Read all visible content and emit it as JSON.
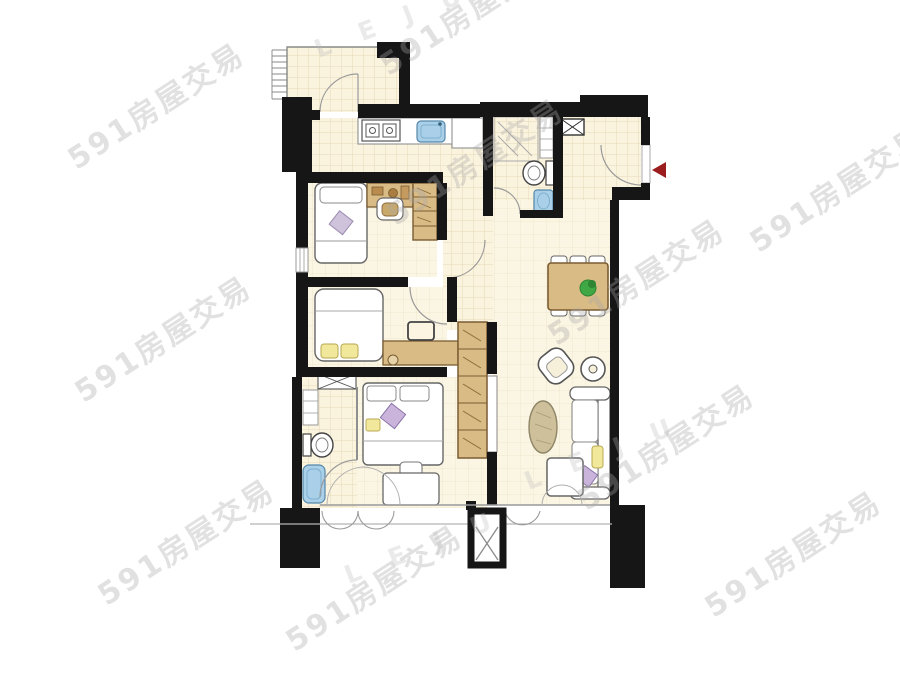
{
  "watermarks": {
    "brand_591": "591房屋交易",
    "brand_leju": "L E J U"
  },
  "colors": {
    "wall": "#161616",
    "floor_cream": "#faf3de",
    "tile_line": "#e6daba",
    "wood": "#d9bb85",
    "wood_border": "#7a5c33",
    "fixture_blue": "#a9d0e8",
    "fixture_blue_border": "#5588aa",
    "pillow_yellow": "#f1e89c",
    "pillow_purple": "#cbb4dc",
    "plant_green": "#3fa744",
    "entrance_marker": "#9b1d1d",
    "watermark_gray": "#a8a8a8"
  }
}
